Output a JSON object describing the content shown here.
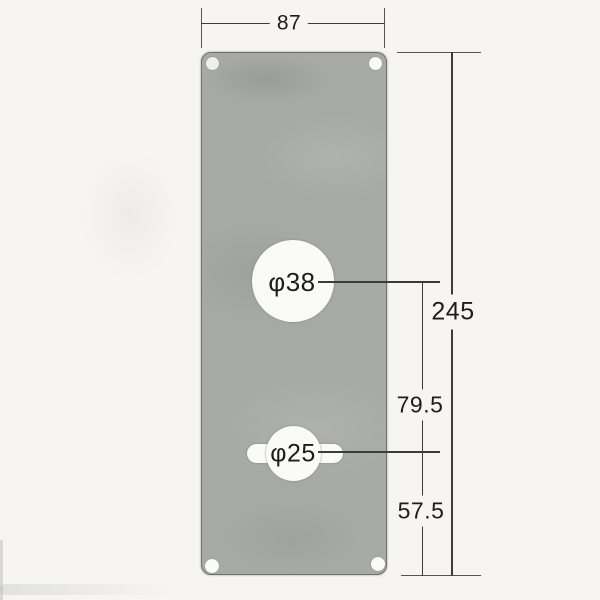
{
  "drawing": {
    "description": "technical dimension drawing of a rectangular door escutcheon plate with two spindle holes and four corner screw holes",
    "labels": {
      "width": "87",
      "height": "245",
      "hole_spacing": "79.5",
      "bottom_offset": "57.5",
      "large_hole": "φ38",
      "small_hole": "φ25"
    },
    "colors": {
      "background": "#f6f5f1",
      "plate": "#a7aaa4",
      "plate_edge": "#6e716c",
      "line": "#3c3c3c",
      "text": "#1d1d1d",
      "hole": "#fafaf8"
    }
  }
}
